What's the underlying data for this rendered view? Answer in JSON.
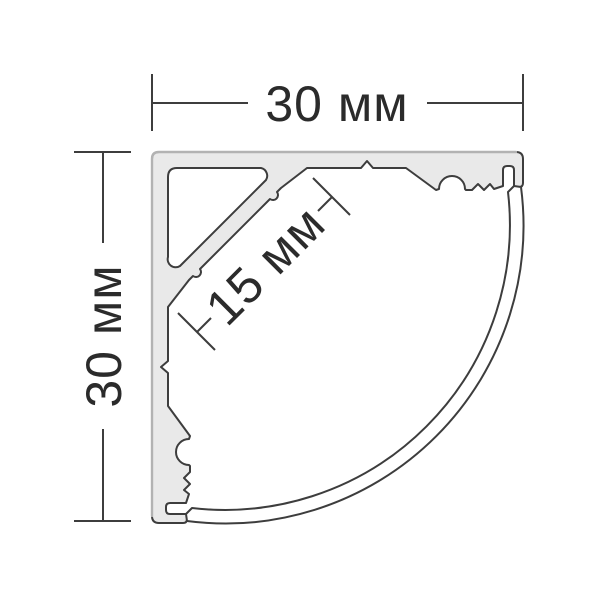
{
  "drawing": {
    "labels": {
      "width": "30 мм",
      "height": "30 мм",
      "led_surface": "15 мм"
    },
    "colors": {
      "profile_fill": "#e9e9e9",
      "outline": "#3d3d3d",
      "outer_edge": "#b2b2b2",
      "dimension_line": "#3d3d3d",
      "label_text": "#2b2b2b",
      "background": "#ffffff"
    }
  }
}
